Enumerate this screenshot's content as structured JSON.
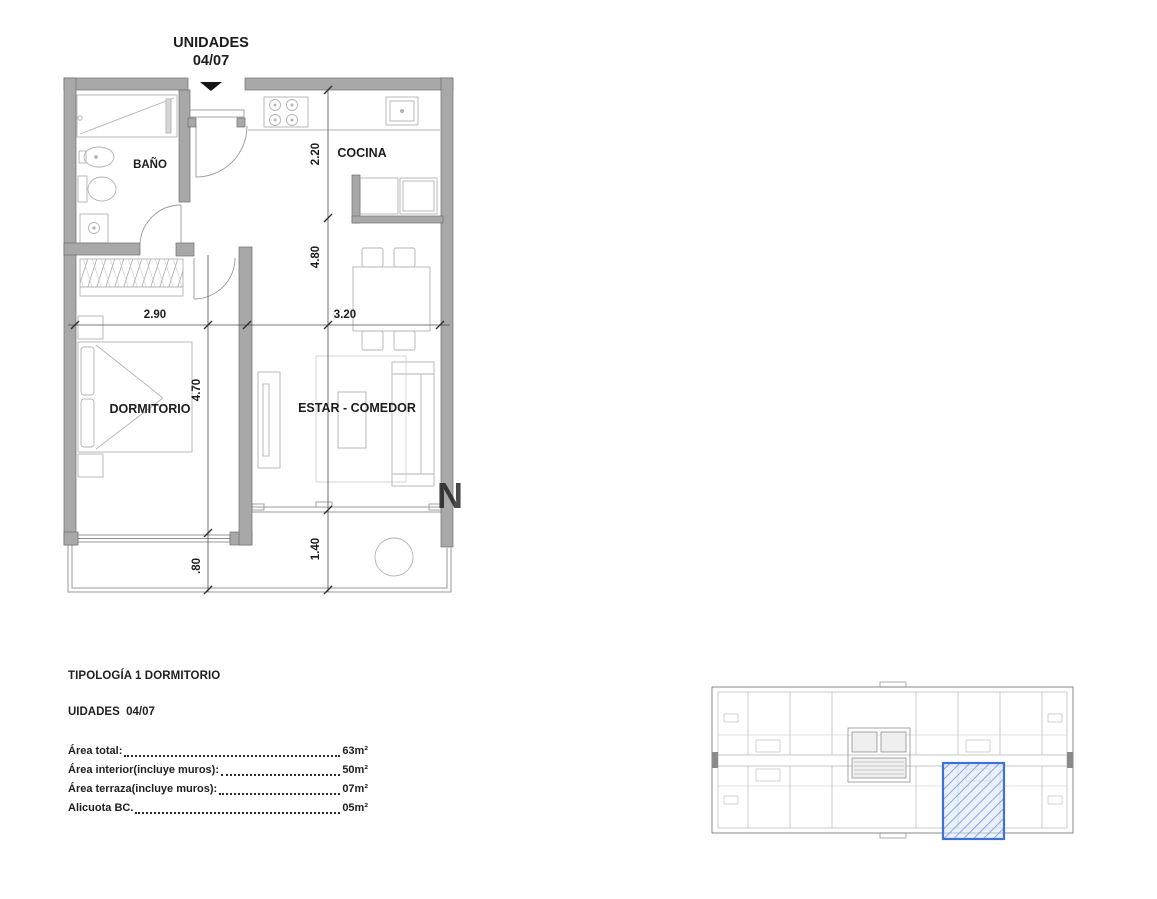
{
  "title": {
    "line1": "UNIDADES",
    "line2": "04/07"
  },
  "floorplan": {
    "rooms": {
      "bathroom": "BAÑO",
      "kitchen": "COCINA",
      "bedroom": "DORMITORIO",
      "living": "ESTAR - COMEDOR"
    },
    "dimensions": {
      "kitchen_depth": "2.20",
      "bedroom_width": "2.90",
      "living_width": "3.20",
      "bedroom_length": "4.70",
      "living_length": "4.80",
      "terrace_left": ".80",
      "terrace_right": "1.40"
    },
    "watermark": "N"
  },
  "info": {
    "typology": "TIPOLOGÍA 1 DORMITORIO",
    "units": "UIDADES  04/07",
    "areas": [
      {
        "label": "Área total:",
        "value": "63m²"
      },
      {
        "label": "Área interior(incluye muros):",
        "value": "50m²"
      },
      {
        "label": "Área terraza(incluye muros):",
        "value": "07m²"
      },
      {
        "label": "Alicuota BC.",
        "value": "05m²"
      }
    ]
  },
  "keyplan": {
    "highlight_color": "#3f6fd8"
  }
}
